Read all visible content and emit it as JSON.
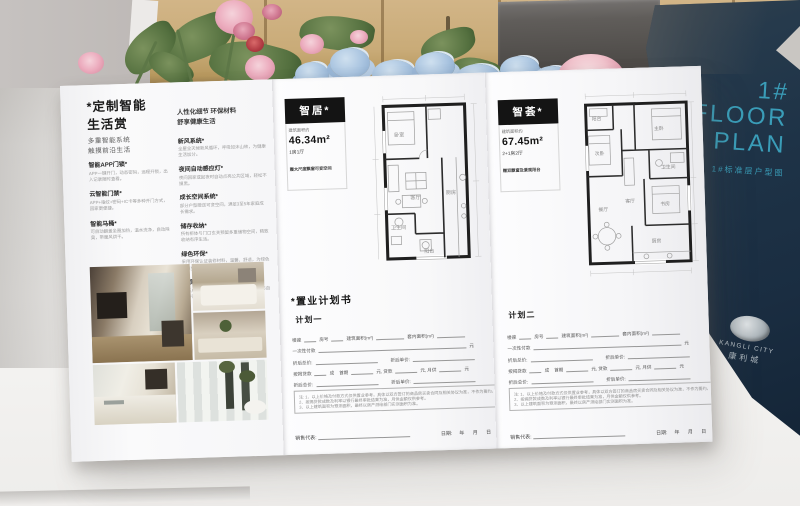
{
  "colors": {
    "cover_navy": "#1d3347",
    "cover_teal": "#3a9db8",
    "paper": "#f8f8f9",
    "ink": "#1a1a1a"
  },
  "cover": {
    "line1": "1#",
    "line2": "FLOOR",
    "line3": "PLAN",
    "subtitle": "1#标准层户型图",
    "brand_en": "KANGLI CITY",
    "brand_cn": "康利城"
  },
  "left_panel": {
    "heading_l1": "*定制智能",
    "heading_l2": "生活赏",
    "sub_l1": "多重智能系统",
    "sub_l2": "触摸前沿生活",
    "items": [
      {
        "t": "智能APP门锁*",
        "d": "APP一键开门，动态密码，远程开锁，出入记录随时查看。"
      },
      {
        "t": "云智能门禁*",
        "d": "APP+指纹+密码+IC卡等多种开门方式，回家更便捷。"
      },
      {
        "t": "智能马桶*",
        "d": "可自动翻盖坐圈加热，温水洗净，自动除臭，带暖风烘干。"
      }
    ],
    "detail_heading_l1": "人性化细节 环保材料",
    "detail_heading_l2": "舒享健康生活",
    "detail_items": [
      {
        "t": "新风系统*",
        "d": "全屋全天候新风循环，呼吸如沐山林，为健康生活加分。"
      },
      {
        "t": "夜间自动感应灯*",
        "d": "夜间回家或起夜时自动点亮公共区域，轻松不摸黑。"
      },
      {
        "t": "成长空间系统*",
        "d": "部分户型赠送可变空间，满足3至5年家庭成长需求。"
      },
      {
        "t": "储存收纳*",
        "d": "所有柜体与门口玄关预留多重储物空间，精致收纳有序生活。"
      },
      {
        "t": "绿色环保*",
        "d": "采用环保认证装修材料，温馨、舒适，为绿色健康生活加分。"
      },
      {
        "t": "景观阳台*",
        "d": "让每户产品都拥有专属观景阳台，让生活与自然亲密对话。"
      }
    ]
  },
  "units": {
    "a": {
      "name": "智居*",
      "area_label": "建筑面积约",
      "area": "46.34m²",
      "rooms": "1房1厅",
      "note": "赠大尺度飘窗可变空间"
    },
    "b": {
      "name": "智荟*",
      "area_label": "建筑面积约",
      "area": "67.45m²",
      "rooms": "2+1房2厅",
      "note": "赠双飘窗及景观阳台"
    }
  },
  "rooms_a": [
    "阳台",
    "卧室",
    "客厅",
    "厨房",
    "卫生间"
  ],
  "rooms_b": [
    "阳台",
    "次卧",
    "主卧",
    "客厅",
    "餐厅",
    "卫生间",
    "书房",
    "厨房"
  ],
  "plan_book": {
    "title": "*置业计划书",
    "plan_one": "计划一",
    "plan_two": "计划二"
  },
  "form": {
    "rows": [
      [
        {
          "l": "楼座"
        },
        {
          "b": 12
        },
        {
          "l": "房号"
        },
        {
          "b": 12
        },
        {
          "l": "建筑面积(m²)"
        },
        {
          "b": 28
        },
        {
          "l": "套内面积(m²)"
        },
        {
          "b": 28
        }
      ],
      [
        {
          "l": "一次性付款"
        },
        {
          "b": 148
        },
        {
          "l": "元"
        }
      ],
      [
        {
          "l": "折后总价:"
        },
        {
          "b": 62
        },
        {
          "g": 10
        },
        {
          "l": "折后单价:"
        },
        {
          "b": 62
        }
      ],
      [
        {
          "l": "按揭贷款"
        },
        {
          "b": 12
        },
        {
          "l": "成"
        },
        {
          "g": 4
        },
        {
          "l": "首期"
        },
        {
          "b": 22
        },
        {
          "l": "元,"
        },
        {
          "l": "贷款"
        },
        {
          "b": 22
        },
        {
          "l": "元,"
        },
        {
          "l": "月供"
        },
        {
          "b": 22
        },
        {
          "l": "元"
        }
      ],
      [
        {
          "l": "折后总价:"
        },
        {
          "b": 62
        },
        {
          "g": 10
        },
        {
          "l": "折后单价:"
        },
        {
          "b": 62
        }
      ]
    ],
    "notes": [
      "注: 1、以上价格及付款方式仅供置业参考，具体以双方签订的商品房买卖合同及相关协议为准，不作为要约。",
      "2、按揭贷款成数及利率以银行最终审批结果为准，月供金额仅供参考。",
      "3、以上建筑面积为预测面积，最终以房产测绘部门实测面积为准。"
    ],
    "footer": {
      "rep": "销售代表:",
      "date": "日期:",
      "ymd": "年 月 日"
    }
  }
}
